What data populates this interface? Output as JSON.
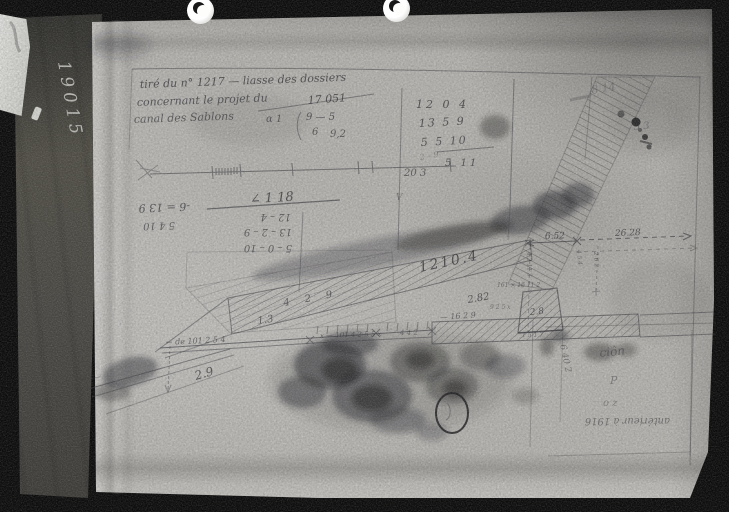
{
  "colors": {
    "frame": "#070707",
    "paper": "#c6c4bf",
    "ink": "#34343b",
    "label_white": "#e8e8e4"
  },
  "archive": {
    "side_number": "19015"
  },
  "title_block": {
    "line1": "tiré du n° 1217 — liasse des dossiers",
    "line2": "concernant le projet du",
    "reference": "17 051",
    "line3": "canal des Sablons"
  },
  "calc_main": {
    "row1": "12 0 4",
    "row2": "13 5 9",
    "row3": "5 5 10",
    "result": "5 11",
    "carry": "20 3"
  },
  "calc_side": {
    "alpha": "α 1",
    "top": "9 — 5",
    "mid": "6",
    "bottom": "9,2"
  },
  "calc_inverted": {
    "heading": "∠ 1 18",
    "col1": "12 – 4",
    "col2": "13 – 2 – 9",
    "col3": "5 – 0 – 10",
    "left1": "-6 = 13 9",
    "left2": "5 4 10"
  },
  "measurements": {
    "band_length": "1210.4",
    "edge_seq": "4  2  9",
    "d13": "1.3",
    "d29": "2.9",
    "d282": "2.82",
    "d1629": "— 16 2 9",
    "dim_left": "6.52",
    "dim_right": "26.28",
    "trap": "2.8",
    "left_note": "← de 101 2 5 4",
    "road_note": "x — 101 4 2 5 5 x",
    "road_note2": "4 4 2",
    "scale_note": "2 – 9",
    "micro1": "161 × 16 11 2",
    "micro2": "2 6 2",
    "micro3": "4 5 4",
    "micro4": "4 2 11 3",
    "micro5": "9 2 5 x",
    "micro6": "1 5 1 7",
    "vert_note": "6 40 2",
    "v_mark": "V"
  },
  "corner_notes": {
    "top_right1": "8 14",
    "top_right2": "5 3",
    "br1": "ciôn",
    "br2": "P",
    "br3": "o z",
    "br_inverted": "antérieur à 1916"
  }
}
